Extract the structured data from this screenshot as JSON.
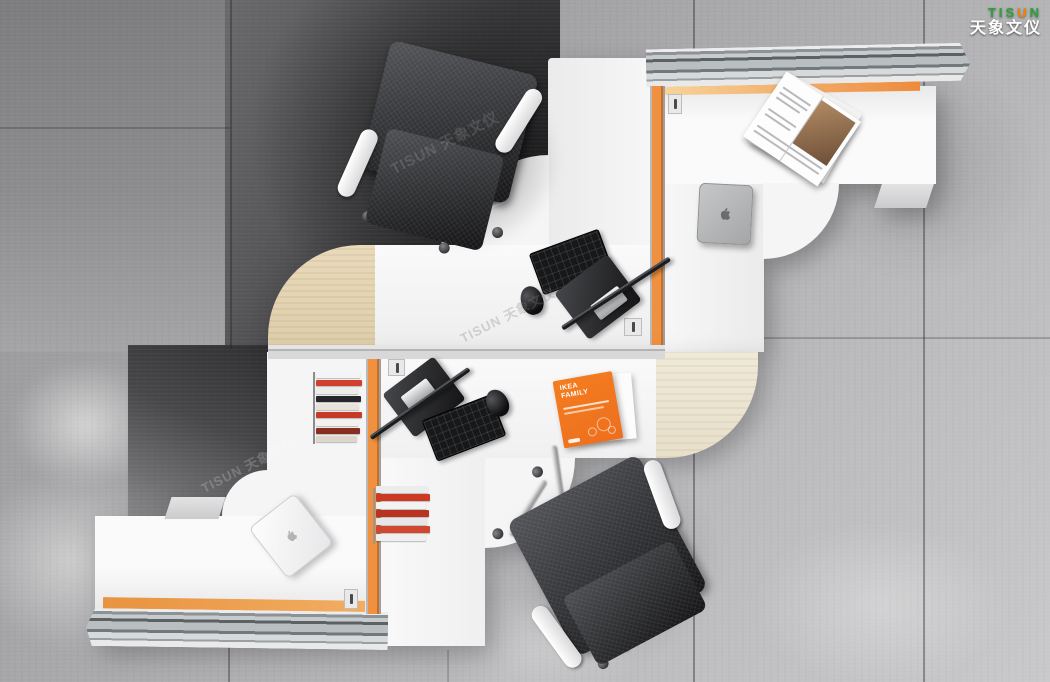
{
  "brand": {
    "latin_prefix": "TIS",
    "latin_accent": "U",
    "latin_suffix": "N",
    "chinese": "天象文仪",
    "green": "#2fa13c",
    "orange": "#f08300"
  },
  "watermark": {
    "text": "TISUN 天象文仪"
  },
  "booklet": {
    "title_line1": "IKEA",
    "title_line2": "FAMILY"
  },
  "palette": {
    "desk_white": "#f5f5f6",
    "wood_beech": "#e3d3b2",
    "wood_cream": "#ece4d2",
    "accent_orange": "#ee8a3c",
    "rail_aluminum": "#c9cdcf",
    "floor_gray": "#a6a6a8",
    "floor_dark": "#3a3a3c",
    "chair_mesh": "#2b2c2e",
    "brochure_orange": "#ee6f1e"
  }
}
